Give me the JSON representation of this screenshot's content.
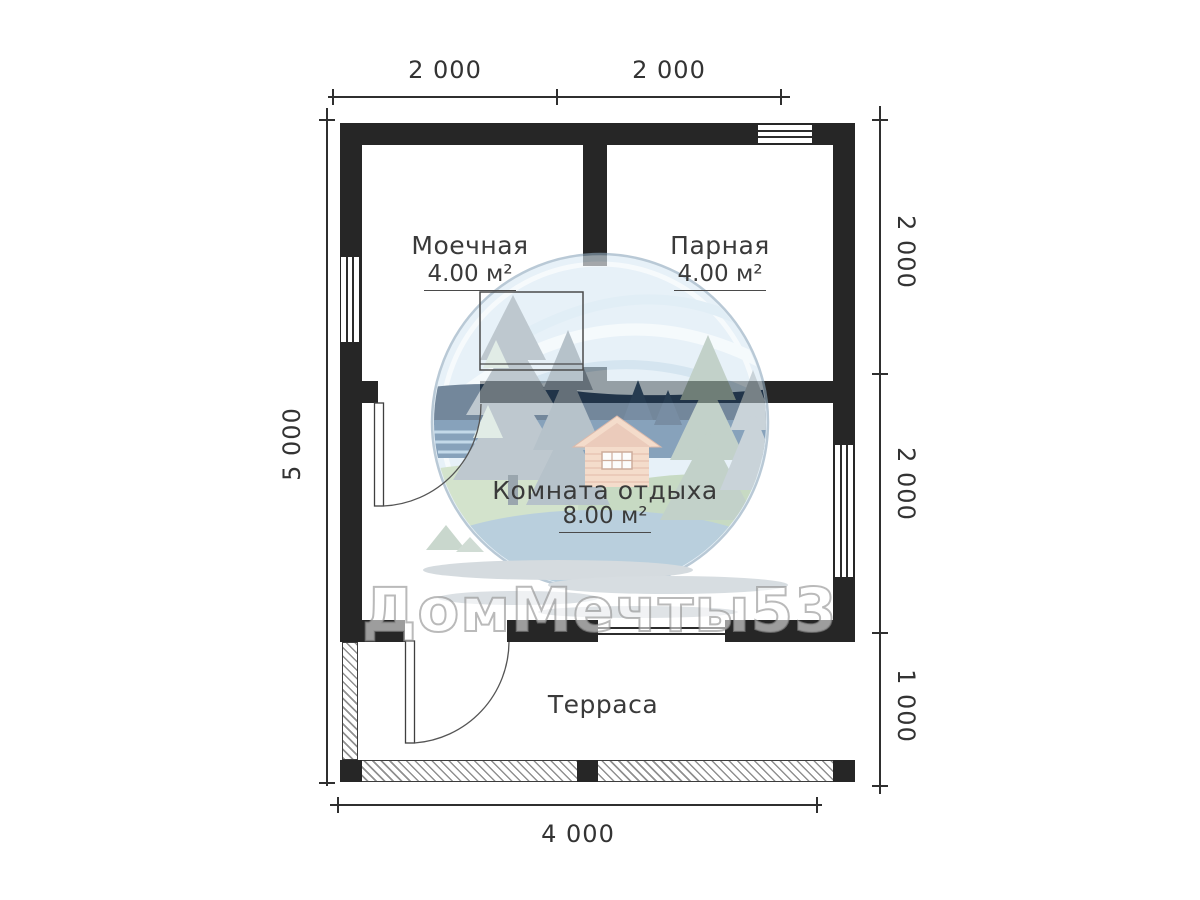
{
  "plan": {
    "watermark_text": "ДомМечты53",
    "rooms": [
      {
        "id": "moechnaya",
        "name": "Моечная",
        "area": "4.00 м²"
      },
      {
        "id": "parnaya",
        "name": "Парная",
        "area": "4.00 м²"
      },
      {
        "id": "komnata-otdyha",
        "name": "Комната отдыха",
        "area": "8.00 м²"
      },
      {
        "id": "terrasa",
        "name": "Терраса",
        "area": ""
      }
    ],
    "dimensions": {
      "top": [
        "2 000",
        "2 000"
      ],
      "bottom": [
        "4 000"
      ],
      "left": [
        "5 000"
      ],
      "right": [
        "2 000",
        "2 000",
        "1 000"
      ]
    },
    "colors": {
      "wall": "#262626",
      "ink": "#3a3a3a",
      "logo_sky": "#d9e9f4",
      "logo_navy": "#1f3e5f",
      "logo_water": "#3f6a93",
      "logo_tree_gray": "#97a8b3",
      "logo_tree_sage": "#9db5a9",
      "logo_grass": "#b9d2ae",
      "logo_cabin": "#eec7ac",
      "logo_cabin_line": "#d79c80",
      "logo_ripple": "#bcc6cc"
    }
  }
}
